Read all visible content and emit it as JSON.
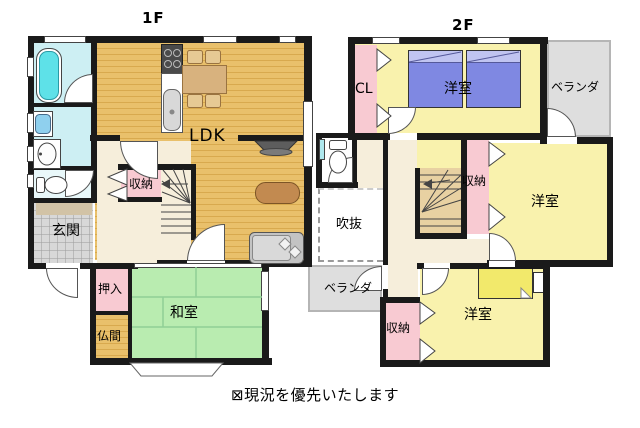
{
  "floor1": {
    "title": "1F",
    "rooms": {
      "ldk": "LDK",
      "genkan": "玄関",
      "shuno": "収納",
      "oshiire": "押入",
      "washitsu": "和室",
      "butsuma": "仏間"
    }
  },
  "floor2": {
    "title": "2F",
    "rooms": {
      "cl": "CL",
      "bedroom_top": "洋室",
      "veranda_top": "ベランダ",
      "shuno_mid": "収納",
      "bedroom_right": "洋室",
      "fukinuke": "吹抜",
      "veranda_bottom": "ベランダ",
      "shuno_bottom": "収納",
      "bedroom_bottom": "洋室"
    }
  },
  "note": "⊠現況を優先いたします",
  "colors": {
    "wall": "#1a1a1a",
    "wood": "#e9c06b",
    "woodline": "#d8a94e",
    "cream": "#f6eedb",
    "pink": "#f8cad2",
    "yellow": "#f9f2ad",
    "green": "#b9ecb0",
    "cyanfloor": "#cdeff3",
    "tub": "#5ee1e8",
    "gray": "#dedede",
    "tile": "#d8d8d8",
    "bedblue": "#7f88e2",
    "bedblue2": "#c0c4f1",
    "bedyellow": "#f2e96b",
    "stairtan": "#e8d1a2",
    "step": "#d2c3a6"
  }
}
